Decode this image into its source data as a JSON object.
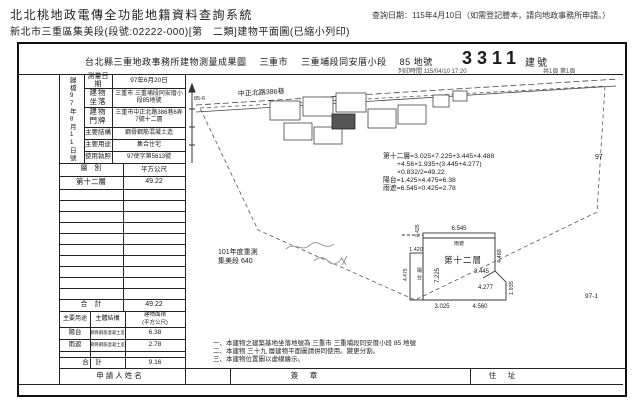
{
  "app": {
    "title": "北北桃地政電傳全功能地籍資料查詢系統",
    "query_date": "查詢日期：115年4月10日（如需登記謄本，請向地政事務所申請。）",
    "subtitle": "新北市三重區集美段(段號:02222-000)[第　二類]建物平面圖(已縮小列印)"
  },
  "doc": {
    "title": "台北縣三重地政事務所建物測量成果圖",
    "city": "三重市",
    "section": "三重埔段同安厝小段",
    "parcel": "85 地號",
    "building_no": "3311",
    "building_no_label": "建號",
    "print_time": "列印時間 115/04/10 17:20",
    "page_info": "共1頁 第1頁",
    "archive_vertical": "歸檔97年8月11日號",
    "info_rows": [
      {
        "label": "測量日期",
        "value": "97年6月20日"
      },
      {
        "label": "建物坐落",
        "value": "三重市 三重埔段同安厝小段85地號"
      },
      {
        "label": "建物門牌",
        "value": "三重市中正北路386巷6弄7號十二層"
      },
      {
        "label": "主要結構",
        "value": "鋼骨鋼筋混凝土造"
      },
      {
        "label": "主要用途",
        "value": "集合住宅"
      },
      {
        "label": "使用執照",
        "value": "97使字第5613號"
      }
    ],
    "floor_table": {
      "col1": "層　別",
      "col2": "平方公尺",
      "rows": [
        {
          "floor": "第十二層",
          "area": "49.22"
        }
      ],
      "total_label": "合　計",
      "total_value": "49.22"
    },
    "annex_table": {
      "col1": "主要用途",
      "col2": "主體結構",
      "col3a": "建物面積",
      "col3b": "(平方公尺)",
      "rows": [
        {
          "use": "陽台",
          "structure": "鋼骨鋼筋混凝土造",
          "area": "6.38"
        },
        {
          "use": "雨遮",
          "structure": "鋼骨鋼筋混凝土造",
          "area": "2.78"
        }
      ],
      "total_label": "合　計",
      "total_value": "9.16"
    },
    "plan": {
      "road_label": "中正北路386巷",
      "lot_85_6": "85-6",
      "lot_97": "97",
      "lot_97_1": "97-1",
      "annotation_line1": "101年度重測",
      "annotation_line2": "集美段 640",
      "formula_lines": [
        "第十二層=3.025×7.225+3.445×4.488",
        "+4.56×1.935+(3.445+4.277)",
        "×0.832/2=49.22",
        "陽台=1.425×4.475=6.38",
        "雨遮=6.545×0.425=2.78"
      ],
      "detail": {
        "title": "第十二層",
        "canopy_label": "雨遮",
        "balcony_label_1": "陽",
        "balcony_label_2": "台",
        "dim_top": "6.545",
        "dim_canopy": "0.425",
        "dim_balcony_w": "1.420",
        "dim_balcony_h": "4.475",
        "dim_inner_v": "7.225",
        "dim_inner_a": "3.445",
        "dim_inner_b": "4.277",
        "dim_right": "4.488",
        "dim_tab": "1.935",
        "dim_bottom_l": "3.025",
        "dim_bottom_r": "4.560"
      }
    },
    "notes": [
      "一、本建物之建築基地坐落地號為 三重市 三重埔段同安厝小段 85 地號",
      "二、本建物 三十九 層建物平面圖請併同使用。變更分割。",
      "三、本建物位置圖以虛線繪示。"
    ],
    "footer": {
      "applicant": "申請人姓名",
      "seal": "簽　章",
      "address": "住　址"
    }
  }
}
